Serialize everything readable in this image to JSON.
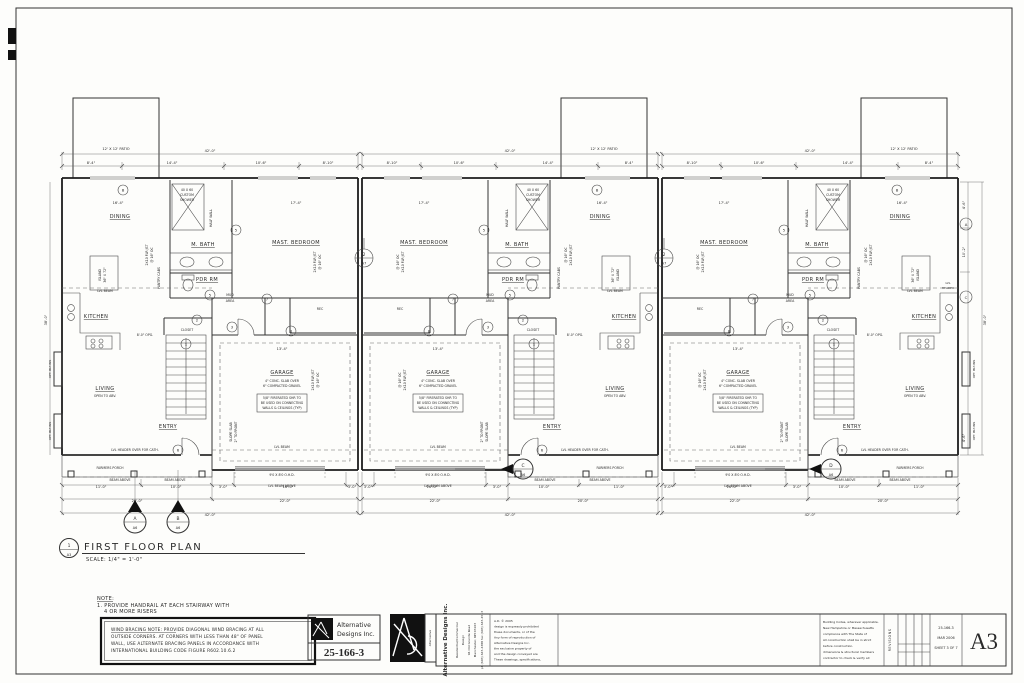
{
  "plan_title": {
    "num": "1",
    "sheet": "A3",
    "title": "FIRST FLOOR PLAN",
    "scale": "SCALE:  1/4\" = 1'-0\""
  },
  "patio_label": "12' X 12' PATIO",
  "unit": {
    "rooms": {
      "dining": "DINING",
      "mbath": "M. BATH",
      "master": "MAST. BEDROOM",
      "pdr": "PDR RM",
      "kitchen": "KITCHEN",
      "rec": "REC",
      "closet": "CLOSET",
      "garage": "GARAGE",
      "living": "LIVING",
      "living_sub": "OPEN TO ABV.",
      "entry": "ENTRY",
      "porch": "FARMERS PORCH",
      "mud1": "MUD",
      "mud2": "AREA"
    },
    "ann": {
      "shower1": "40 X 60",
      "shower2": "CUSTOM",
      "shower3": "SHOWER",
      "halfwall": "HALF WALL",
      "pantry": "PANTRY CABS",
      "island1": "ISLAND",
      "island2": "36\" X 72\"",
      "lvlbeam": "LVL BEAM",
      "slab1": "4\" CONC. SLAB OVER",
      "slab2": "6\" COMPACTED GRAVEL",
      "fire1": "5/8\" FIRERATED SHR TO",
      "fire2": "BE USED ON CONNECTING",
      "fire3": "WALLS & CEILINGS (TYP)",
      "slope1": "SLOPE SLAB",
      "slope2": "2\" TO FRONT",
      "ohd": "9'0 X 8'0 O.H.D.",
      "lvlabove": "LVL BEAM ABOVE",
      "beamabove": "BEAM ABOVE",
      "header_cath": "LVL HEADER OVER FOR CATH.",
      "opg": "8'-0\" OPG.",
      "joist1": "2X10 FLR JST",
      "joist2": "@ 16\" OC",
      "optblt": "OPT. BLT-INS",
      "lvlheader1": "LVL",
      "lvlheader2": "HEADER"
    },
    "dims": {
      "top": [
        "8'-4\"",
        "14'-4\"",
        "10'-6\"",
        "8'-10\""
      ],
      "top_total": "42'-0\"",
      "bed_w": "17'-4\"",
      "din_w": "16'-4\"",
      "gar_w": "13'-4\"",
      "b1": [
        "11'-0\"",
        "10'-0\"",
        "3'-0\"",
        "16'-0\"",
        "3'-0\""
      ],
      "b2": [
        "20'-0\"",
        "22'-0\""
      ],
      "total": "42'-0\""
    }
  },
  "side_dims": {
    "r1": "4'-6\"",
    "r2": "10'-2\"",
    "r3": "4'-6\"",
    "depth": "38'-0\""
  },
  "tags": {
    "t1": "1",
    "t2": "2",
    "t3": "3",
    "t5": "5",
    "t6": "6",
    "t7": "7",
    "t8": "8",
    "wA": "A",
    "wB": "B",
    "wC": "C"
  },
  "detail": {
    "num": "2",
    "sheet": "A7"
  },
  "sections": {
    "a": "A",
    "b": "B",
    "c": "C",
    "d": "D",
    "sheet": "A6"
  },
  "notes": {
    "title": "NOTE:",
    "l1": "1. PROVIDE HANDRAIL AT EACH STAIRWAY WITH",
    "l2": "4 OR MORE RISERS"
  },
  "wind": {
    "l1": "WIND BRACING NOTE:  PROVIDE DIAGONAL WIND BRACING AT ALL",
    "l2": "OUTSIDE CORNERS.  AT  CORNERS WITH LESS THAN 48\"  OF PANEL",
    "l3": "WALL, USE ALTERNATE BRACING PANELS IN ACCORDANCE WITH",
    "l4": "INTERNATIONAL BUILDING CODE FIGURE R602.10.6.2"
  },
  "logo1": {
    "name1": "Alternative",
    "name2": "Designs Inc.",
    "job": "25-166-3"
  },
  "logo2": {
    "rot": "Alternative"
  },
  "company": {
    "name": "Alternative Designs Inc.",
    "lines": [
      "Residential/Commercial",
      "Design",
      "94 Old Granite Road",
      "Manchester, NH 03103",
      "ph (603) 645-4388  fax (603) 645-4513"
    ]
  },
  "copyright": {
    "lines": [
      "A.D. © 2005",
      "design is expressly prohibited",
      "these documents, or of the",
      "Any form of reproduction of",
      "Alternative Designs Inc.",
      "the exclusive property of",
      "and the design conveyed are",
      "These drawings, specifications,"
    ]
  },
  "codes": {
    "lines": [
      "Building Codes, wherever applicable.",
      "New Hampshire or Massachusetts",
      "compliance with The State of",
      "All construction shall be in strict",
      "before construction.",
      "dimensions & structural members",
      "contractor to check & verify all"
    ]
  },
  "revisions": "REVISIONS",
  "sheetinfo": {
    "job": "25-166-3",
    "date": "MAR 2006",
    "sheet": "SHEET 3 OF 7",
    "big": "A3"
  }
}
